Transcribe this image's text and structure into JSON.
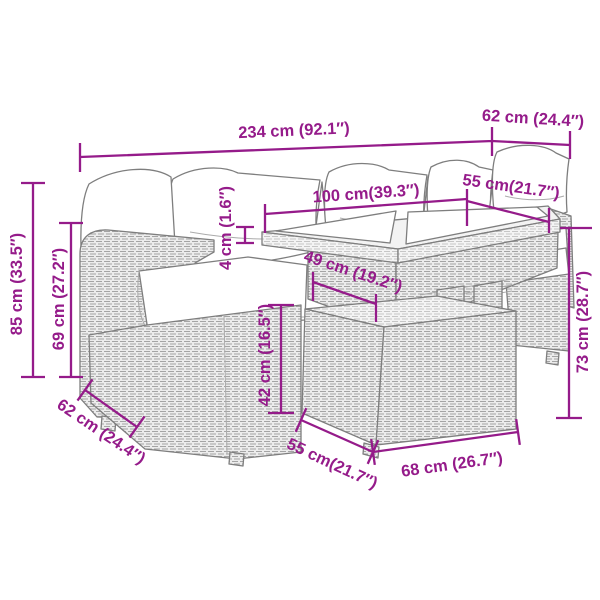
{
  "page": {
    "kind": "product-dimension-diagram",
    "product": "5-piece rattan garden lounge set with cushions and glass-top table"
  },
  "colors": {
    "accent": "#951B8A",
    "line_art": "#7E7E7E",
    "weave_fill": "#ECECEC",
    "cushion": "#FFFFFF"
  },
  "dimensions": {
    "overall_width": "234 cm (92.1″)",
    "corner_section_depth": "62 cm (24.4″)",
    "table_length": "100 cm(39.3″)",
    "right_section_width": "55 cm(21.7″)",
    "glass_thickness": "4 cm (1.6″)",
    "table_lower_length": "49 cm (19.2″)",
    "backrest_height": "85 cm (33.5″)",
    "side_height": "69 cm (27.2″)",
    "seat_section_depth": "62 cm (24.4″)",
    "seat_height": "42 cm (16.5″)",
    "table_base_depth": "55 cm(21.7″)",
    "table_base_length": "68 cm (26.7″)",
    "table_height": "73 cm (28.7″)"
  }
}
